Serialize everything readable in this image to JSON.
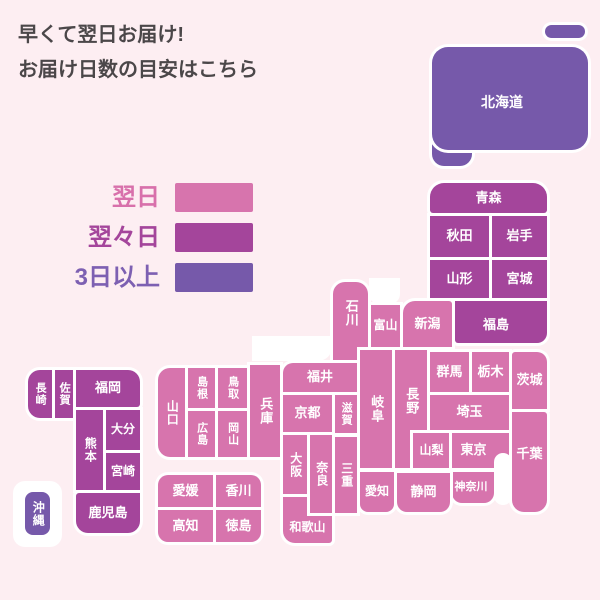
{
  "header": {
    "line1": "早くて翌日お届け!",
    "line2": "お届け日数の目安はこちら"
  },
  "legend": {
    "items": [
      {
        "label": "翌日",
        "color": "#d774ad",
        "text_color": "#d870ab"
      },
      {
        "label": "翌々日",
        "color": "#a4459b",
        "text_color": "#a4459b"
      },
      {
        "label": "3日以上",
        "color": "#7659aa",
        "text_color": "#7d60b2"
      }
    ]
  },
  "colors": {
    "next_day": "#d774ad",
    "two_days": "#a4459b",
    "three_plus": "#7659aa",
    "background": "#fdeef2",
    "box_label": "#ffffff",
    "title_text": "#4b4749"
  },
  "map": {
    "sea_before": [
      {
        "x": 13,
        "y": 481,
        "w": 49,
        "h": 66,
        "r": "12px"
      },
      {
        "x": 252,
        "y": 336,
        "w": 80,
        "h": 25,
        "r": "0 0 14px 0"
      },
      {
        "x": 369,
        "y": 278,
        "w": 31,
        "h": 26,
        "r": "0 0 10px 10px"
      }
    ],
    "sea_after": [
      {
        "x": 494,
        "y": 453,
        "w": 18,
        "h": 52,
        "r": "10px"
      }
    ],
    "prefectures": [
      {
        "label": "",
        "x": 432,
        "y": 135,
        "w": 40,
        "h": 31,
        "r": "0 0 12px 12px",
        "delivery": "three_plus"
      },
      {
        "label": "北海道",
        "x": 432,
        "y": 47,
        "w": 156,
        "h": 103,
        "r": "16px",
        "delivery": "three_plus",
        "fs": 14,
        "off": [
          -8,
          4
        ]
      },
      {
        "label": "",
        "x": 545,
        "y": 25,
        "w": 40,
        "h": 13,
        "r": "7px",
        "delivery": "three_plus"
      },
      {
        "label": "青森",
        "x": 430,
        "y": 183,
        "w": 117,
        "h": 30,
        "r": "14px 14px 3px 3px",
        "delivery": "two_days"
      },
      {
        "label": "秋田",
        "x": 430,
        "y": 216,
        "w": 59,
        "h": 41,
        "delivery": "two_days"
      },
      {
        "label": "岩手",
        "x": 492,
        "y": 216,
        "w": 55,
        "h": 41,
        "delivery": "two_days"
      },
      {
        "label": "山形",
        "x": 430,
        "y": 260,
        "w": 59,
        "h": 38,
        "delivery": "two_days"
      },
      {
        "label": "宮城",
        "x": 492,
        "y": 260,
        "w": 55,
        "h": 38,
        "delivery": "two_days"
      },
      {
        "label": "福島",
        "x": 455,
        "y": 301,
        "w": 92,
        "h": 42,
        "r": "0 0 10px 3px",
        "delivery": "two_days",
        "off": [
          -5,
          3
        ]
      },
      {
        "label": "石川",
        "x": 333,
        "y": 282,
        "w": 35,
        "h": 78,
        "r": "12px 12px 0 0",
        "delivery": "next_day",
        "vertical": true,
        "off": [
          0,
          -8
        ]
      },
      {
        "label": "新潟",
        "x": 403,
        "y": 301,
        "w": 49,
        "h": 46,
        "r": "12px 3px 0 0",
        "delivery": "next_day"
      },
      {
        "label": "富山",
        "x": 371,
        "y": 305,
        "w": 29,
        "h": 42,
        "delivery": "next_day",
        "fs": 12
      },
      {
        "label": "福井",
        "x": 283,
        "y": 363,
        "w": 74,
        "h": 29,
        "r": "10px 0 0 0",
        "delivery": "next_day"
      },
      {
        "label": "岐阜",
        "x": 360,
        "y": 350,
        "w": 32,
        "h": 118,
        "delivery": "next_day",
        "vertical": true
      },
      {
        "label": "長野",
        "x": 395,
        "y": 350,
        "w": 32,
        "h": 118,
        "delivery": "next_day",
        "vertical": true,
        "off": [
          0,
          -8
        ]
      },
      {
        "label": "山梨",
        "x": 413,
        "y": 433,
        "w": 37,
        "h": 35,
        "delivery": "next_day",
        "fs": 12
      },
      {
        "label": "群馬",
        "x": 430,
        "y": 352,
        "w": 39,
        "h": 40,
        "delivery": "next_day"
      },
      {
        "label": "栃木",
        "x": 472,
        "y": 352,
        "w": 37,
        "h": 40,
        "delivery": "next_day"
      },
      {
        "label": "茨城",
        "x": 512,
        "y": 352,
        "w": 35,
        "h": 57,
        "r": "3px 10px 0 0",
        "delivery": "next_day"
      },
      {
        "label": "埼玉",
        "x": 430,
        "y": 395,
        "w": 79,
        "h": 35,
        "delivery": "next_day"
      },
      {
        "label": "東京",
        "x": 452,
        "y": 433,
        "w": 57,
        "h": 35,
        "delivery": "next_day",
        "off": [
          -7,
          0
        ]
      },
      {
        "label": "千葉",
        "x": 512,
        "y": 412,
        "w": 35,
        "h": 100,
        "r": "0 3px 12px 12px",
        "delivery": "next_day",
        "off": [
          0,
          -8
        ]
      },
      {
        "label": "神奈川",
        "x": 452,
        "y": 472,
        "w": 42,
        "h": 31,
        "r": "0 0 10px 10px",
        "delivery": "next_day",
        "fs": 11,
        "off": [
          -2,
          0
        ]
      },
      {
        "label": "静岡",
        "x": 397,
        "y": 473,
        "w": 53,
        "h": 39,
        "r": "0 0 10px 10px",
        "delivery": "next_day"
      },
      {
        "label": "愛知",
        "x": 360,
        "y": 472,
        "w": 34,
        "h": 40,
        "r": "0 0 8px 8px",
        "delivery": "next_day",
        "fs": 12
      },
      {
        "label": "兵庫",
        "x": 250,
        "y": 365,
        "w": 30,
        "h": 92,
        "delivery": "next_day",
        "vertical": true
      },
      {
        "label": "京都",
        "x": 283,
        "y": 395,
        "w": 49,
        "h": 37,
        "delivery": "next_day"
      },
      {
        "label": "滋賀",
        "x": 335,
        "y": 395,
        "w": 22,
        "h": 38,
        "delivery": "next_day",
        "vertical": true,
        "fs": 11
      },
      {
        "label": "大阪",
        "x": 283,
        "y": 435,
        "w": 24,
        "h": 59,
        "delivery": "next_day",
        "vertical": true,
        "fs": 12
      },
      {
        "label": "和歌山",
        "x": 283,
        "y": 497,
        "w": 49,
        "h": 46,
        "r": "0 0 3px 12px",
        "delivery": "next_day",
        "fs": 12,
        "off": [
          0,
          8
        ]
      },
      {
        "label": "奈良",
        "x": 310,
        "y": 435,
        "w": 22,
        "h": 78,
        "delivery": "next_day",
        "vertical": true,
        "fs": 12
      },
      {
        "label": "三重",
        "x": 335,
        "y": 437,
        "w": 22,
        "h": 76,
        "delivery": "next_day",
        "vertical": true,
        "fs": 12
      },
      {
        "label": "山口",
        "x": 158,
        "y": 368,
        "w": 27,
        "h": 89,
        "r": "12px 0 0 12px",
        "delivery": "next_day",
        "vertical": true,
        "fs": 12
      },
      {
        "label": "島根",
        "x": 188,
        "y": 368,
        "w": 27,
        "h": 40,
        "delivery": "next_day",
        "vertical": true,
        "fs": 11
      },
      {
        "label": "鳥取",
        "x": 218,
        "y": 368,
        "w": 29,
        "h": 40,
        "delivery": "next_day",
        "vertical": true,
        "fs": 11
      },
      {
        "label": "広島",
        "x": 188,
        "y": 411,
        "w": 27,
        "h": 46,
        "delivery": "next_day",
        "vertical": true,
        "fs": 11
      },
      {
        "label": "岡山",
        "x": 218,
        "y": 411,
        "w": 29,
        "h": 46,
        "delivery": "next_day",
        "vertical": true,
        "fs": 11
      },
      {
        "label": "愛媛",
        "x": 158,
        "y": 475,
        "w": 55,
        "h": 32,
        "r": "10px 0 0 0",
        "delivery": "next_day"
      },
      {
        "label": "香川",
        "x": 216,
        "y": 475,
        "w": 45,
        "h": 32,
        "r": "0 10px 0 0",
        "delivery": "next_day"
      },
      {
        "label": "高知",
        "x": 158,
        "y": 510,
        "w": 55,
        "h": 32,
        "r": "0 0 0 10px",
        "delivery": "next_day"
      },
      {
        "label": "徳島",
        "x": 216,
        "y": 510,
        "w": 45,
        "h": 32,
        "r": "0 0 10px 0",
        "delivery": "next_day"
      },
      {
        "label": "長崎",
        "x": 28,
        "y": 370,
        "w": 24,
        "h": 48,
        "r": "12px 0 0 12px",
        "delivery": "two_days",
        "vertical": true,
        "fs": 11
      },
      {
        "label": "佐賀",
        "x": 55,
        "y": 370,
        "w": 18,
        "h": 48,
        "delivery": "two_days",
        "vertical": true,
        "fs": 11
      },
      {
        "label": "福岡",
        "x": 76,
        "y": 370,
        "w": 64,
        "h": 37,
        "r": "0 12px 3px 0",
        "delivery": "two_days"
      },
      {
        "label": "熊本",
        "x": 76,
        "y": 410,
        "w": 27,
        "h": 80,
        "delivery": "two_days",
        "vertical": true,
        "fs": 12
      },
      {
        "label": "大分",
        "x": 106,
        "y": 410,
        "w": 34,
        "h": 40,
        "delivery": "two_days",
        "fs": 12
      },
      {
        "label": "宮崎",
        "x": 106,
        "y": 453,
        "w": 34,
        "h": 37,
        "delivery": "two_days",
        "fs": 12
      },
      {
        "label": "鹿児島",
        "x": 76,
        "y": 493,
        "w": 64,
        "h": 40,
        "r": "3px 0 12px 12px",
        "delivery": "two_days"
      },
      {
        "label": "沖縄",
        "x": 25,
        "y": 492,
        "w": 25,
        "h": 43,
        "r": "8px",
        "delivery": "three_plus",
        "vertical": true,
        "fs": 12
      }
    ]
  }
}
